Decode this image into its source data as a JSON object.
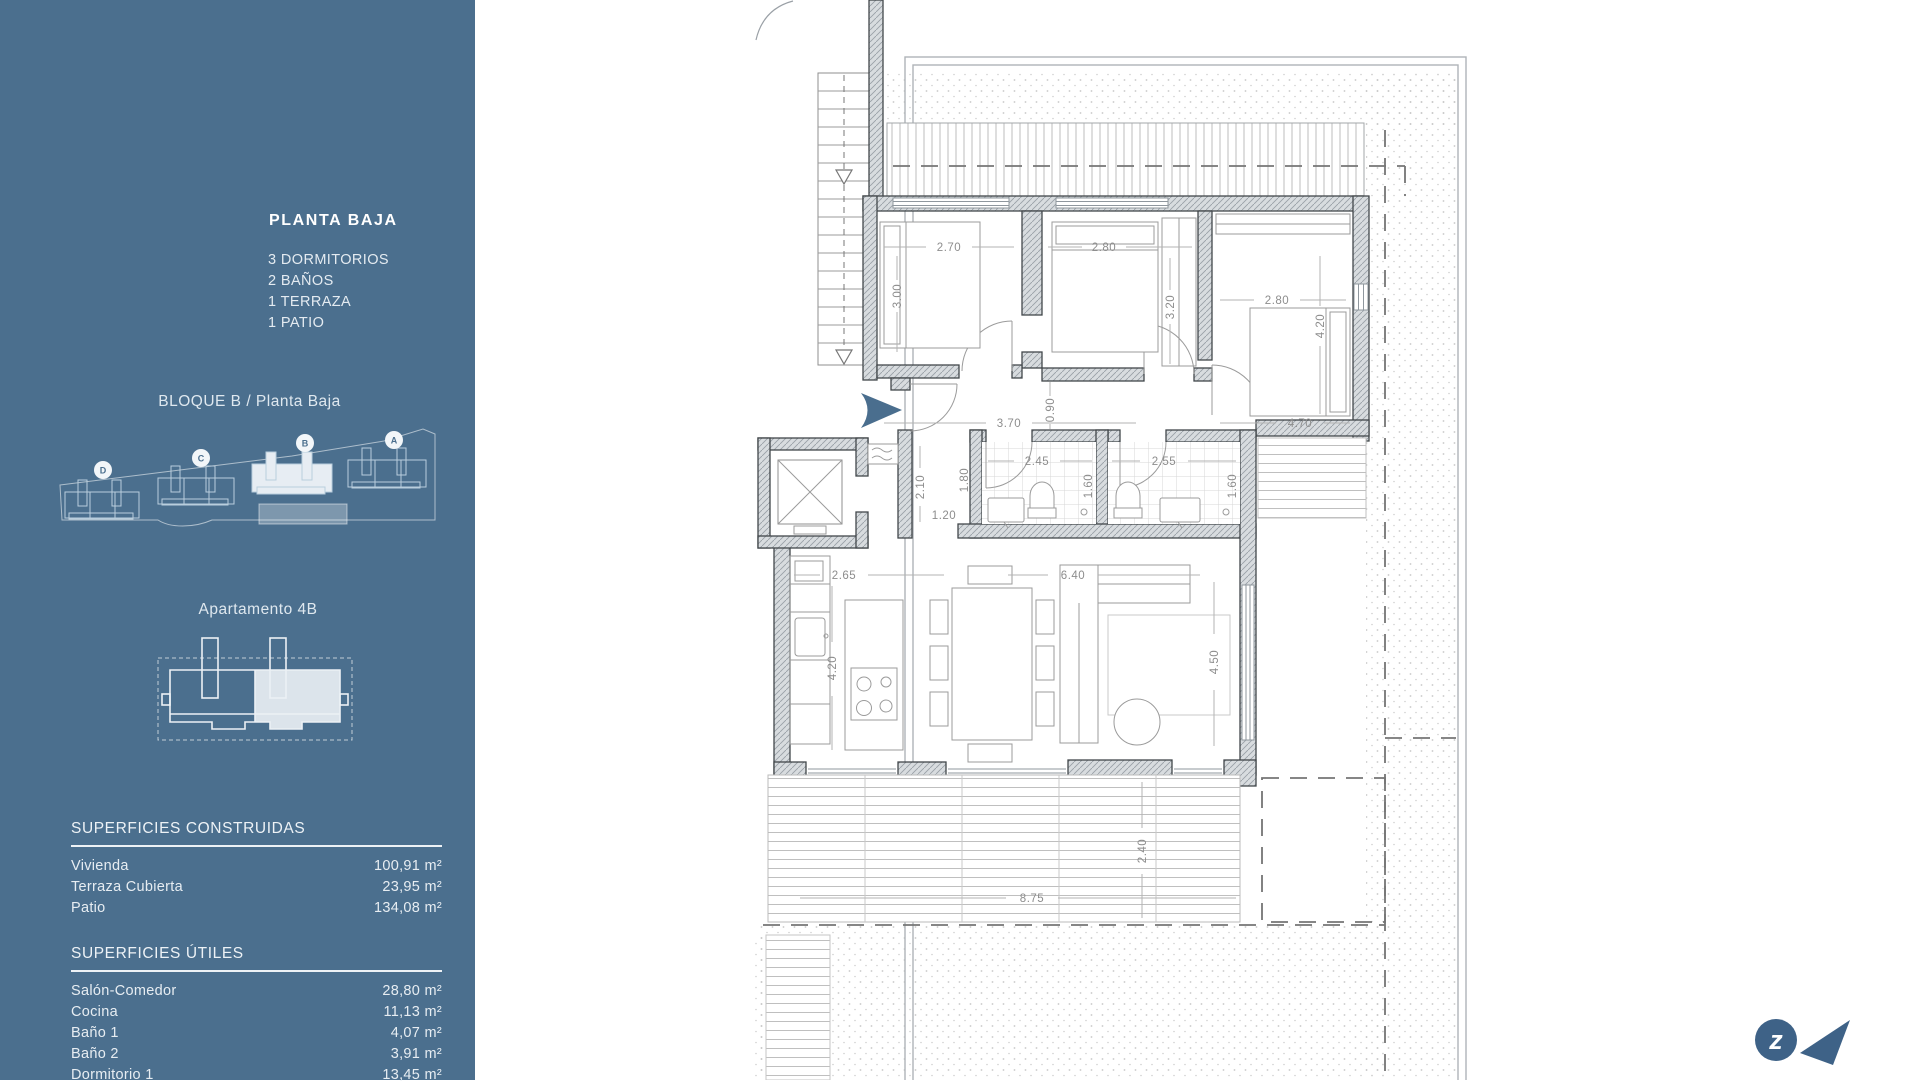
{
  "sidebar": {
    "title": "PLANTA BAJA",
    "features": [
      "3 DORMITORIOS",
      "2 BAÑOS",
      "1 TERRAZA",
      "1 PATIO"
    ],
    "block_label": "BLOQUE B / Planta Baja",
    "site_buildings": [
      "D",
      "C",
      "B",
      "A"
    ],
    "apartment_label": "Apartamento 4B",
    "surfaces_built": {
      "heading": "SUPERFICIES CONSTRUIDAS",
      "rows": [
        {
          "label": "Vivienda",
          "value": "100,91 m²"
        },
        {
          "label": "Terraza Cubierta",
          "value": "23,95 m²"
        },
        {
          "label": "Patio",
          "value": "134,08 m²"
        }
      ]
    },
    "surfaces_useful": {
      "heading": "SUPERFICIES ÚTILES",
      "rows": [
        {
          "label": "Salón-Comedor",
          "value": "28,80 m²"
        },
        {
          "label": "Cocina",
          "value": "11,13 m²"
        },
        {
          "label": "Baño 1",
          "value": "4,07 m²"
        },
        {
          "label": "Baño 2",
          "value": "3,91 m²"
        },
        {
          "label": "Dormitorio 1",
          "value": "13,45 m²"
        }
      ]
    },
    "colors": {
      "background": "#4B6F8E",
      "text": "#E9EFF4"
    }
  },
  "plan": {
    "bedroom1": {
      "w": "2.70",
      "d": "3.00"
    },
    "bedroom2": {
      "w": "2.80",
      "d": "3.20"
    },
    "bedroom3": {
      "w": "2.80",
      "d": "4.20"
    },
    "hall": {
      "left": "3.70",
      "mid": "0.90",
      "right": "4.70"
    },
    "bath1": {
      "w": "2.45",
      "d": "1.80",
      "d2": "1.60"
    },
    "bath2": {
      "w": "2.55",
      "d2": "1.60"
    },
    "entry": {
      "d": "2.10",
      "w": "1.20"
    },
    "kitchen": {
      "w": "2.65",
      "d": "4.20"
    },
    "living": {
      "w": "6.40",
      "d": "4.50"
    },
    "terrace": {
      "w": "8.75",
      "d": "2.40"
    },
    "accent": "#4A6E8E"
  },
  "logo": {
    "letter": "z",
    "color": "#3E6287"
  }
}
